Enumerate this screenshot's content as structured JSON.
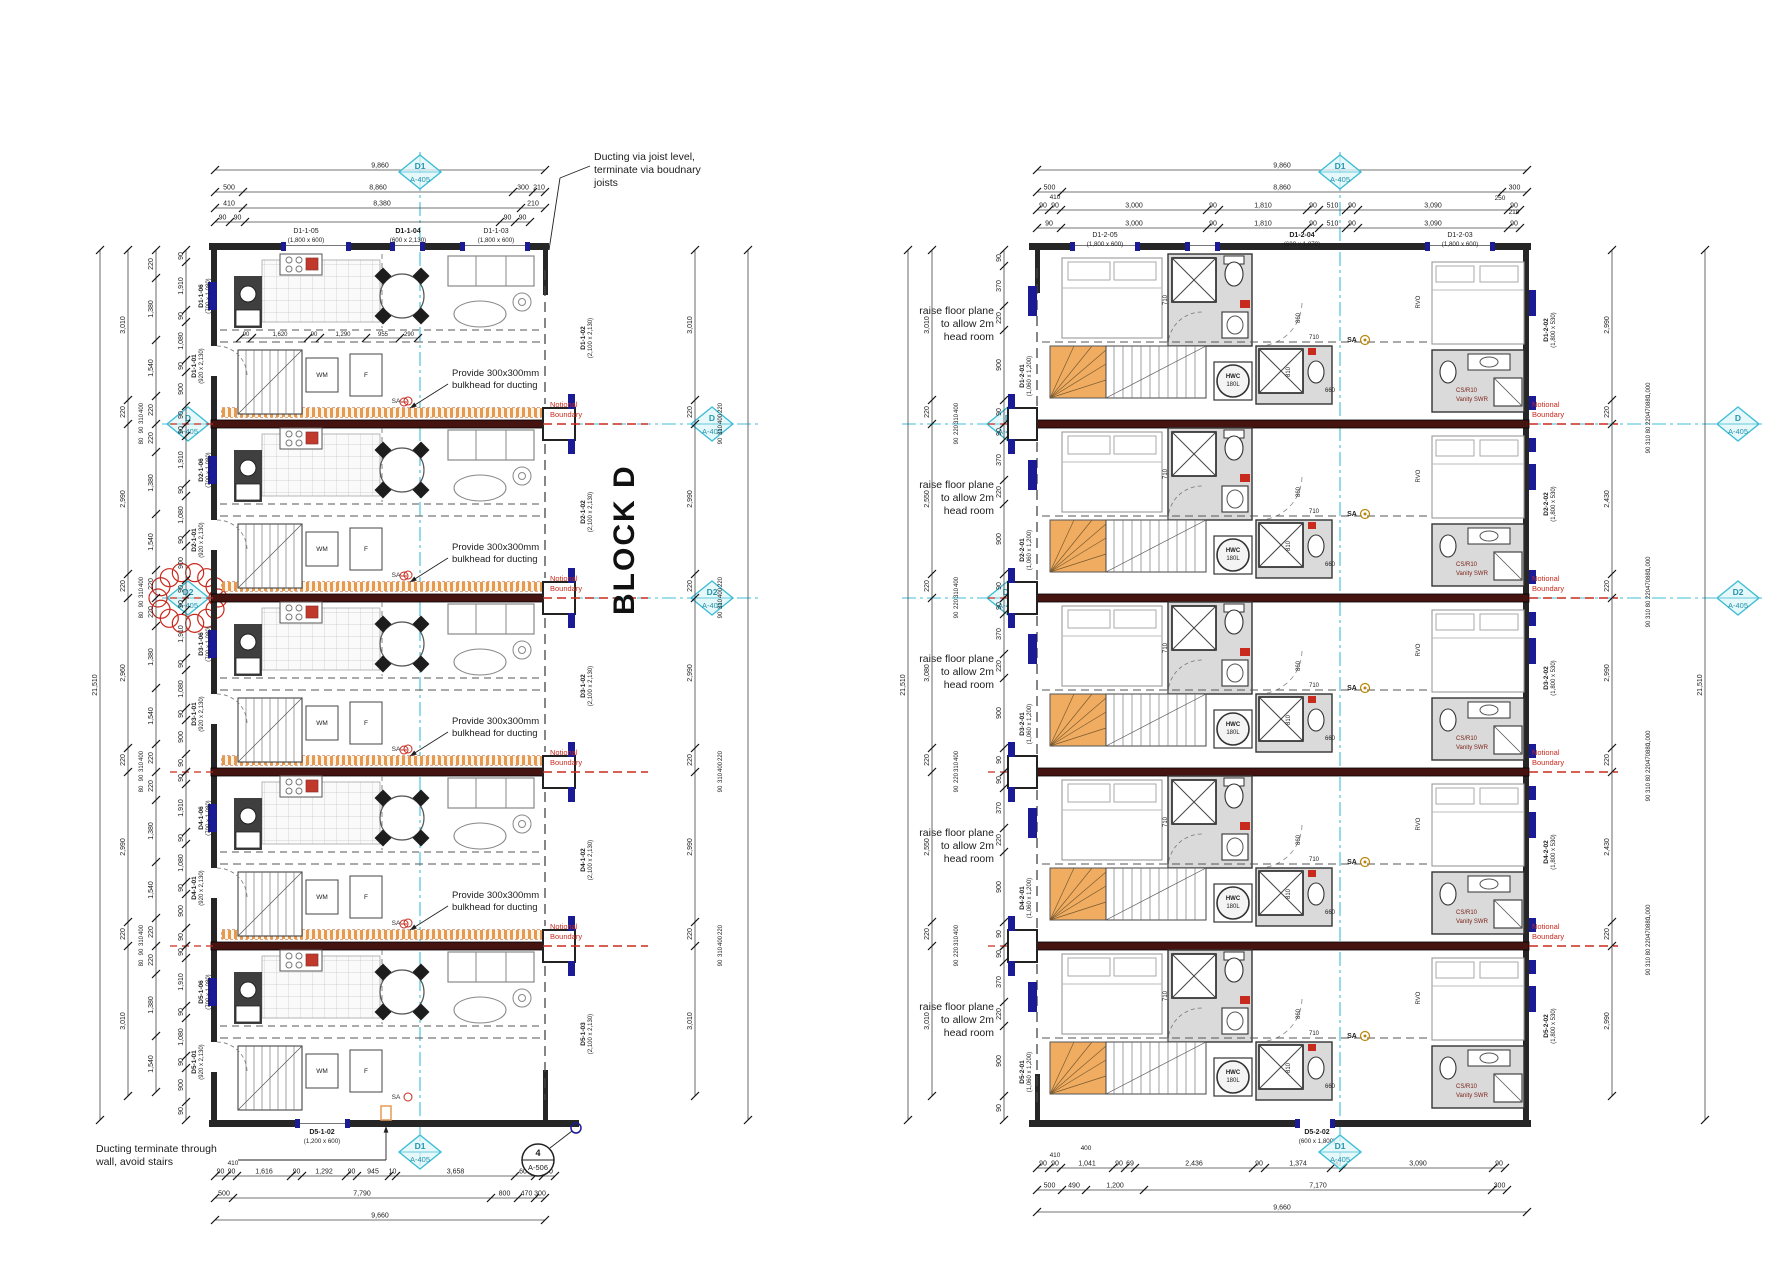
{
  "title": {
    "block": "BLOCK D"
  },
  "colors": {
    "grid_cyan": "#3fbdd4",
    "boundary_red": "#c92a1e",
    "duct_orange": "#e59a50",
    "stair_orange": "#f0ad62",
    "bath_gray": "#dadada",
    "window_navy": "#1b1b96",
    "wall": "#262626",
    "party": "#451410",
    "dim": "#1c1c1c",
    "fixture": "#8a8a8a"
  },
  "annotations": {
    "ducting_joist": [
      "Ducting via joist level,",
      "terminate via boudnary",
      "joists"
    ],
    "bulkhead": [
      "Provide 300x300mm",
      "bulkhead for ducting"
    ],
    "terminate": [
      "Ducting terminate through",
      "wall, avoid stairs"
    ],
    "raise_floor": [
      "raise floor plane",
      "to allow 2m",
      "head room"
    ],
    "notional": [
      "Notional",
      "Boundary"
    ],
    "revision_tag": "E"
  },
  "markers": {
    "d1": {
      "id": "D1",
      "sheet": "A-405"
    },
    "d": {
      "id": "D",
      "sheet": "A-405"
    },
    "d2": {
      "id": "D2",
      "sheet": "A-405"
    },
    "section": {
      "num": "4",
      "sheet": "A-506"
    }
  },
  "left_plan": {
    "top_openings": [
      {
        "name": "D1-1-05",
        "size": "(1,800 x 600)"
      },
      {
        "name": "D1-1-04",
        "size": "(600 x 2,130)"
      },
      {
        "name": "D1-1-03",
        "size": "(1,800 x 600)"
      }
    ],
    "bottom_opening": {
      "name": "D5-1-02",
      "size": "(1,200 x 600)"
    },
    "units": [
      {
        "win": "D1-1-06",
        "win_size": "(700 x 1,080)",
        "door": "D1-1-01",
        "door_size": "(920 x 2,130)",
        "right": "D1-1-02",
        "right_size": "(2,100 x 2,130)"
      },
      {
        "win": "D2-1-06",
        "win_size": "(700 x 1,080)",
        "door": "D2-1-01",
        "door_size": "(920 x 2,130)",
        "right": "D2-1-02",
        "right_size": "(2,100 x 2,130)"
      },
      {
        "win": "D3-1-06",
        "win_size": "(700 x 1,080)",
        "door": "D3-1-01",
        "door_size": "(920 x 2,130)",
        "right": "D3-1-02",
        "right_size": "(2,100 x 2,130)"
      },
      {
        "win": "D4-1-06",
        "win_size": "(700 x 1,080)",
        "door": "D4-1-01",
        "door_size": "(920 x 2,130)",
        "right": "D4-1-02",
        "right_size": "(2,100 x 2,130)"
      },
      {
        "win": "D5-1-06",
        "win_size": "(700 x 1,080)",
        "door": "D5-1-01",
        "door_size": "(920 x 2,130)",
        "right": "D5-1-03",
        "right_size": "(2,100 x 2,130)"
      }
    ],
    "fixtures": {
      "wm": "WM",
      "fridge": "F",
      "sa": "SA"
    },
    "interior_dims": [
      "90",
      "1,620",
      "90",
      "1,290",
      "955",
      "290"
    ],
    "dims": {
      "top_rows": [
        [
          {
            "t": "9,860",
            "w": 330
          }
        ],
        [
          {
            "t": "500",
            "w": 28
          },
          {
            "t": "8,860",
            "w": 270
          },
          {
            "t": "300",
            "w": 20
          },
          {
            "t": "210",
            "w": 12
          }
        ],
        [
          {
            "t": "410",
            "w": 28
          },
          {
            "t": "8,380",
            "w": 278
          },
          {
            "t": "210",
            "w": 24
          }
        ],
        [
          {
            "t": "90",
            "w": 15
          },
          {
            "t": "90",
            "w": 15
          },
          {
            "t": "",
            "w": 255
          },
          {
            "t": "90",
            "w": 15
          },
          {
            "t": "90",
            "w": 15
          }
        ]
      ],
      "bottom_rows": [
        [
          {
            "t": "90",
            "w": 11
          },
          {
            "t": "90",
            "w": 11
          },
          {
            "t": "1,616",
            "w": 54
          },
          {
            "t": "90",
            "w": 11
          },
          {
            "t": "1,292",
            "w": 44
          },
          {
            "t": "90",
            "w": 11
          },
          {
            "t": "945",
            "w": 32
          },
          {
            "t": "10",
            "w": 7
          },
          {
            "t": "3,658",
            "w": 119
          },
          {
            "t": "600",
            "w": 20
          },
          {
            "t": "80",
            "w": 8
          },
          {
            "t": "90",
            "w": 12
          }
        ],
        [
          {
            "t": "500",
            "w": 18
          },
          {
            "t": "7,790",
            "w": 258
          },
          {
            "t": "800",
            "w": 27
          },
          {
            "t": "470",
            "w": 17
          },
          {
            "t": "300",
            "w": 10
          }
        ],
        [
          {
            "t": "9,660",
            "w": 330
          }
        ]
      ],
      "bottom_pre": "410",
      "side_total": "21,510",
      "unit_depths": [
        "3,010",
        "2,990",
        "2,960",
        "2,990",
        "3,010"
      ],
      "party_cluster": [
        "400",
        "310",
        "90",
        "80"
      ],
      "mid_col": [
        "220",
        "1,380",
        "1,540",
        "220"
      ],
      "inner_col": [
        "90",
        "1,910",
        "90",
        "1,080",
        "90",
        "900",
        "90"
      ],
      "right_units": [
        "3,010",
        "2,990",
        "2,990",
        "2,990",
        "3,010"
      ],
      "right_cluster": [
        "220",
        "400",
        "310",
        "90"
      ]
    }
  },
  "right_plan": {
    "top_openings": [
      {
        "name": "D1-2-05",
        "size": "(1,800 x 600)"
      },
      {
        "name": "D1-2-04",
        "size": "(600 x 1,070)"
      },
      {
        "name": "D1-2-03",
        "size": "(1,800 x 600)"
      }
    ],
    "bottom_opening": {
      "name": "D5-2-02",
      "size": "(600 x 1,800)"
    },
    "units": [
      {
        "left": "D1-2-01",
        "left_size": "(1,060 x 1,200)",
        "right": "D1-2-02",
        "right_size": "(1,800 x 530)"
      },
      {
        "left": "D2-2-01",
        "left_size": "(1,060 x 1,200)",
        "right": "D2-2-02",
        "right_size": "(1,800 x 530)"
      },
      {
        "left": "D3-2-01",
        "left_size": "(1,060 x 1,200)",
        "right": "D3-2-02",
        "right_size": "(1,800 x 530)"
      },
      {
        "left": "D4-2-01",
        "left_size": "(1,060 x 1,200)",
        "right": "D4-2-02",
        "right_size": "(1,800 x 530)"
      },
      {
        "left": "D5-2-01",
        "left_size": "(1,060 x 1,200)",
        "right": "D5-2-02",
        "right_size": "(1,800 x 530)"
      }
    ],
    "fixtures": {
      "hwc1": "HWC",
      "hwc2": "180L",
      "sa": "SA",
      "rvo": "RVO",
      "cs": "CS/R10",
      "vanity": "Vanity SWR"
    },
    "bath_dims": {
      "d710": "710",
      "d810": "810",
      "d860": "860",
      "d660": "660"
    },
    "dims": {
      "top_rows": [
        [
          {
            "t": "9,860",
            "w": 490
          }
        ],
        [
          {
            "t": "500",
            "w": 25
          },
          {
            "t": "8,860",
            "w": 440
          },
          {
            "t": "300",
            "w": 25
          }
        ],
        [
          {
            "t": "90",
            "w": 12
          },
          {
            "t": "90",
            "w": 12
          },
          {
            "t": "3,000",
            "w": 146
          },
          {
            "t": "90",
            "w": 12
          },
          {
            "t": "1,810",
            "w": 88
          },
          {
            "t": "90",
            "w": 12
          },
          {
            "t": "510",
            "w": 27
          },
          {
            "t": "90",
            "w": 12
          },
          {
            "t": "3,090",
            "w": 150
          },
          {
            "t": "90",
            "w": 12
          }
        ],
        [
          {
            "t": "90",
            "w": 24
          },
          {
            "t": "3,000",
            "w": 146
          },
          {
            "t": "90",
            "w": 12
          },
          {
            "t": "1,810",
            "w": 88
          },
          {
            "t": "90",
            "w": 12
          },
          {
            "t": "510",
            "w": 27
          },
          {
            "t": "90",
            "w": 12
          },
          {
            "t": "3,090",
            "w": 150
          },
          {
            "t": "90",
            "w": 12
          }
        ]
      ],
      "top_pre": "410",
      "top_post": [
        "250",
        "210"
      ],
      "bottom_rows": [
        [
          {
            "t": "90",
            "w": 12
          },
          {
            "t": "90",
            "w": 12
          },
          {
            "t": "1,041",
            "w": 52
          },
          {
            "t": "90",
            "w": 12
          },
          {
            "t": "69",
            "w": 10
          },
          {
            "t": "2,436",
            "w": 118
          },
          {
            "t": "90",
            "w": 12
          },
          {
            "t": "1,374",
            "w": 66
          },
          {
            "t": "90",
            "w": 12
          },
          {
            "t": "3,090",
            "w": 150
          },
          {
            "t": "90",
            "w": 12
          }
        ],
        [
          {
            "t": "500",
            "w": 25
          },
          {
            "t": "490",
            "w": 24
          },
          {
            "t": "1,200",
            "w": 58
          },
          {
            "t": "7,170",
            "w": 348
          },
          {
            "t": "300",
            "w": 15
          }
        ],
        [
          {
            "t": "9,660",
            "w": 490
          }
        ]
      ],
      "bottom_pre": [
        "410",
        "400"
      ],
      "side_total": "21,510",
      "unit_depths": [
        "3,010",
        "2,550",
        "3,080",
        "2,550",
        "3,010"
      ],
      "party_cluster": [
        "400",
        "310",
        "220",
        "90"
      ],
      "inner_col": [
        "90",
        "370",
        "220",
        "900",
        "90"
      ],
      "right_units": [
        "2,990",
        "2,430",
        "2,990",
        "2,430",
        "2,990"
      ],
      "right_cluster": [
        "1,000",
        "880",
        "470",
        "220",
        "80",
        "310",
        "90"
      ]
    }
  }
}
